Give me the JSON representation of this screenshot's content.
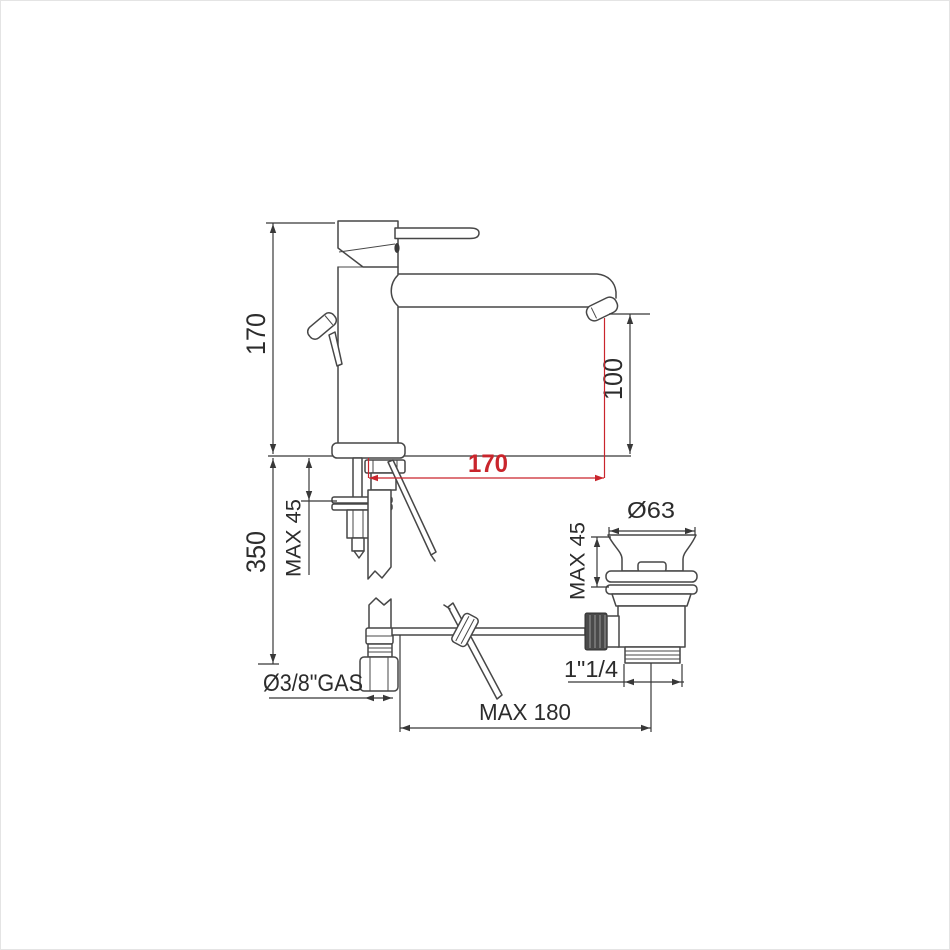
{
  "figure": {
    "colors": {
      "line": "#474747",
      "dimension": "#383838",
      "accent_red": "#c9252c",
      "background": "#ffffff"
    },
    "dims": {
      "total_height": "170",
      "outlet_height": "100",
      "spout_reach": "170",
      "under_counter_length": "350",
      "deck_thickness_max": "MAX 45",
      "waste_clamp_max": "MAX 45",
      "waste_cap_diameter": "Ø63",
      "supply_connection": "Ø3/8\"GAS",
      "waste_outlet_thread": "1\"1/4",
      "rod_reach_max": "MAX 180"
    }
  }
}
